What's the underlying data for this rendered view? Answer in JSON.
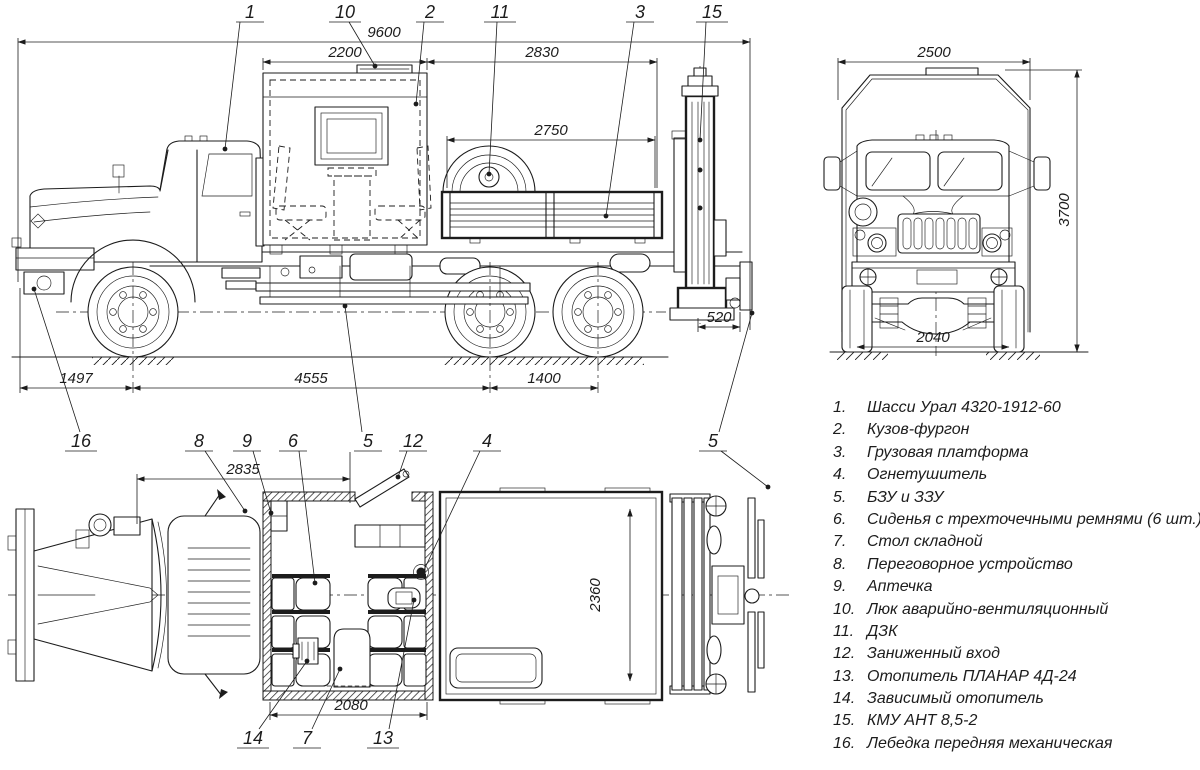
{
  "colors": {
    "ink": "#1c1c1c",
    "background": "#ffffff"
  },
  "callouts": {
    "c1": "1",
    "c2": "2",
    "c3": "3",
    "c4": "4",
    "c5a": "5",
    "c5b": "5",
    "c6": "6",
    "c7": "7",
    "c8": "8",
    "c9": "9",
    "c10": "10",
    "c11": "11",
    "c12": "12",
    "c13": "13",
    "c14": "14",
    "c15": "15",
    "c16": "16"
  },
  "dims": {
    "overall_length": "9600",
    "van_length": "2200",
    "platform_length": "2830",
    "platform_inner_length": "2750",
    "rear_overhang": "520",
    "front_overhang": "1497",
    "wheelbase": "4555",
    "bogie_spacing": "1400",
    "overall_width": "2500",
    "overall_height": "3700",
    "track": "2040",
    "cab_to_door": "2835",
    "van_body_length": "2080",
    "platform_width": "2360"
  },
  "parts_list": {
    "items": [
      {
        "num": "1.",
        "name": "Шасси Урал 4320-1912-60"
      },
      {
        "num": "2.",
        "name": "Кузов-фургон"
      },
      {
        "num": "3.",
        "name": "Грузовая платформа"
      },
      {
        "num": "4.",
        "name": "Огнетушитель"
      },
      {
        "num": "5.",
        "name": "БЗУ и ЗЗУ"
      },
      {
        "num": "6.",
        "name": "Сиденья с трехточечными ремнями (6 шт.)"
      },
      {
        "num": "7.",
        "name": "Стол складной"
      },
      {
        "num": "8.",
        "name": "Переговорное устройство"
      },
      {
        "num": "9.",
        "name": "Аптечка"
      },
      {
        "num": "10.",
        "name": "Люк аварийно-вентиляционный"
      },
      {
        "num": "11.",
        "name": "ДЗК"
      },
      {
        "num": "12.",
        "name": "Заниженный вход"
      },
      {
        "num": "13.",
        "name": "Отопитель ПЛАНАР 4Д-24"
      },
      {
        "num": "14.",
        "name": "Зависимый отопитель"
      },
      {
        "num": "15.",
        "name": "КМУ АНТ 8,5-2"
      },
      {
        "num": "16.",
        "name": "Лебедка передняя механическая"
      }
    ]
  }
}
